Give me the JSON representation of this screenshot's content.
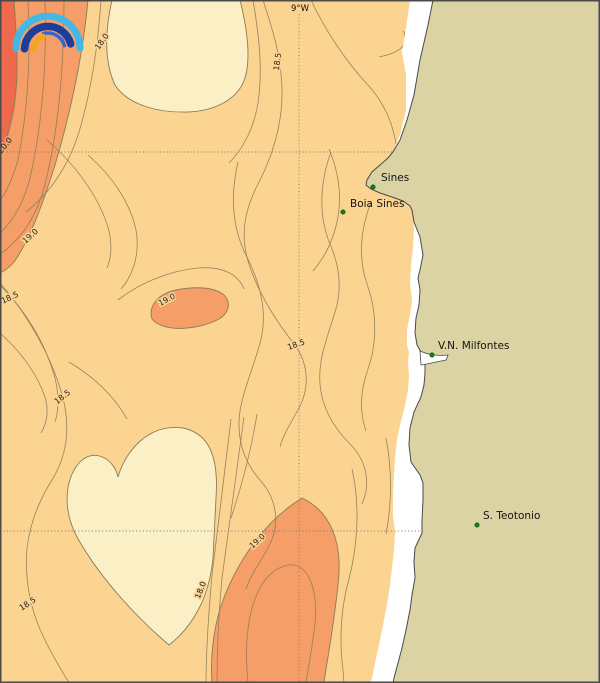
{
  "map": {
    "top_axis_label": "9°W",
    "places": [
      {
        "name": "Sines"
      },
      {
        "name": "Boia Sines"
      },
      {
        "name": "V.N. Milfontes"
      },
      {
        "name": "S. Teotonio"
      }
    ],
    "contour_labels": [
      {
        "value": "18.0"
      },
      {
        "value": "18.5"
      },
      {
        "value": "20.0"
      },
      {
        "value": "19.0"
      },
      {
        "value": "18.5"
      },
      {
        "value": "19.0"
      },
      {
        "value": "18.5"
      },
      {
        "value": "18.5"
      },
      {
        "value": "19.0"
      },
      {
        "value": "18.0"
      },
      {
        "value": "18.5"
      }
    ],
    "temperature_bands": [
      {
        "range": "below 18.0",
        "color": "#FBEFC5"
      },
      {
        "range": "18.0 - 19.0",
        "color": "#FBD491"
      },
      {
        "range": "19.0 - 20.0",
        "color": "#F59E67"
      },
      {
        "range": "above 20.0",
        "color": "#EF6A4C"
      }
    ],
    "colors": {
      "ocean_base": "#FBD491",
      "land": "#DBD3A4",
      "coastal_strip": "#FFFFFF",
      "contour_line": "#8B7B58",
      "coastline": "#4A4A4A",
      "graticule": "#777777",
      "place_marker": "#15830F"
    }
  },
  "logo": {
    "name": "met-institute-arcs-logo",
    "arc_colors": [
      "#41B8E8",
      "#1C3E9B",
      "#3565CF",
      "#F2A51D"
    ]
  }
}
